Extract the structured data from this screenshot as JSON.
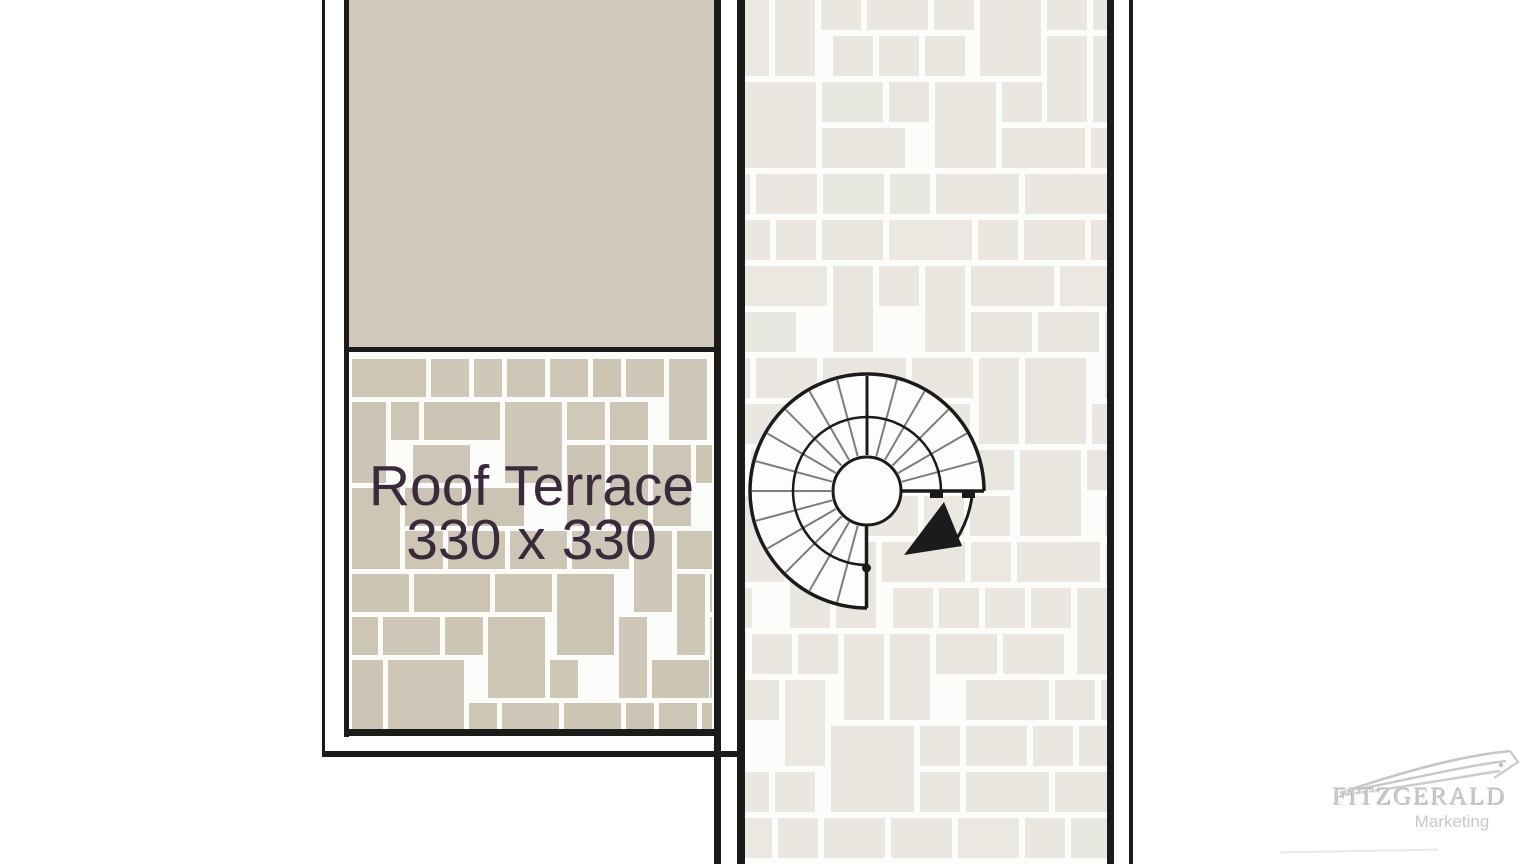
{
  "plan": {
    "roof_terrace": {
      "label": "Roof Terrace",
      "dimensions": "330 x 330"
    },
    "staircase": {
      "icon": "spiral-staircase-icon",
      "arrow_icon": "curved-direction-arrow-icon"
    }
  },
  "branding": {
    "company": "FITZGERALD",
    "tagline": "Marketing",
    "icon": "swoosh-logo-icon"
  },
  "colors": {
    "background": "#ffffff",
    "wall": "#1b1b1b",
    "upper_room_fill": "#d1cabc",
    "terrace_tile": "#ccc4b3",
    "walkway_tile": "#e8e6de",
    "grout": "#fcfcfa",
    "label_text": "#3a2a3c",
    "tread_line": "#7d7d7d",
    "logo_gray": "#c9c9c9"
  }
}
